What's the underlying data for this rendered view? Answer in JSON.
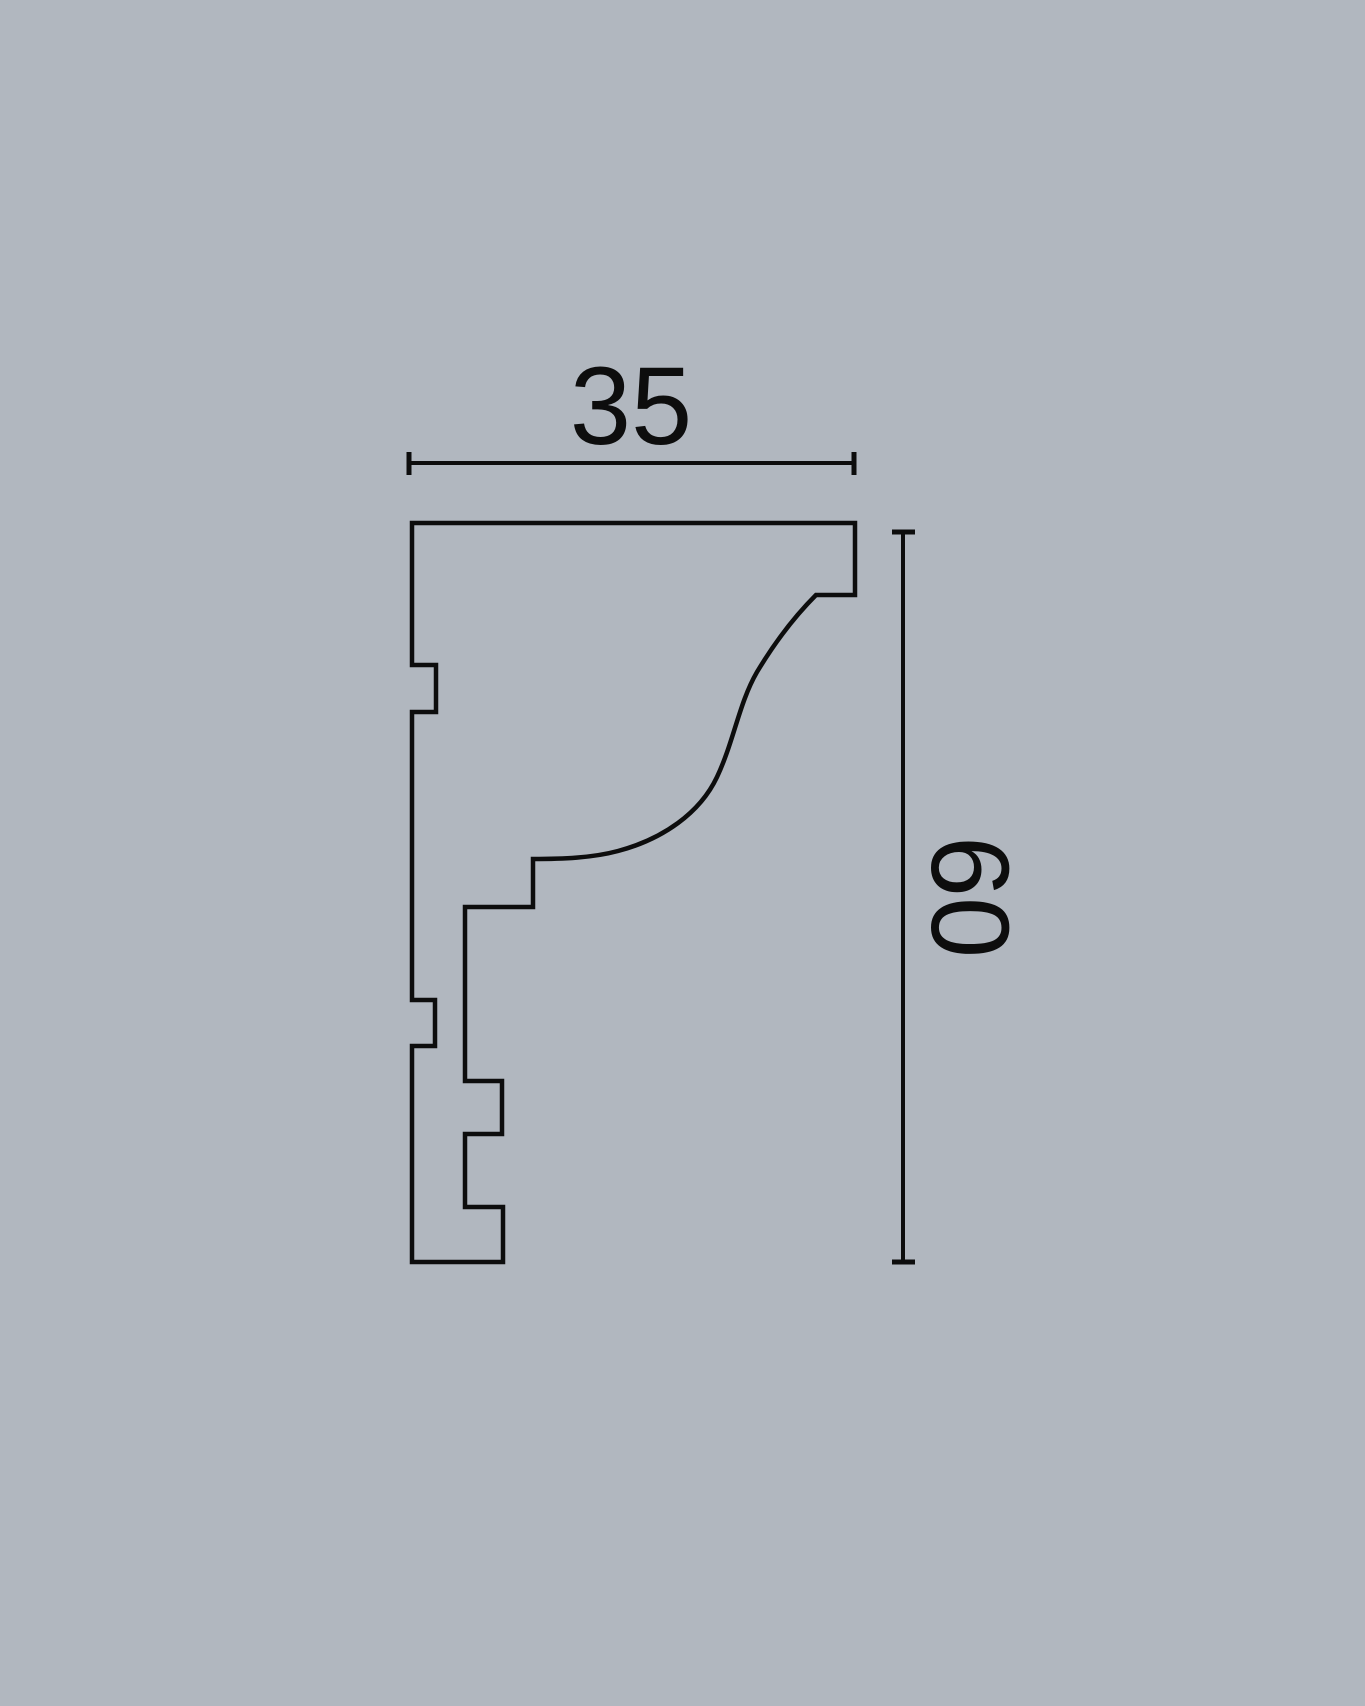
{
  "drawing": {
    "type": "molding-profile-cross-section",
    "dimensions": {
      "width": {
        "label": "35"
      },
      "height": {
        "label": "60"
      }
    },
    "colors": {
      "background": "#b1b7bf",
      "line": "#0d0d0d"
    }
  }
}
